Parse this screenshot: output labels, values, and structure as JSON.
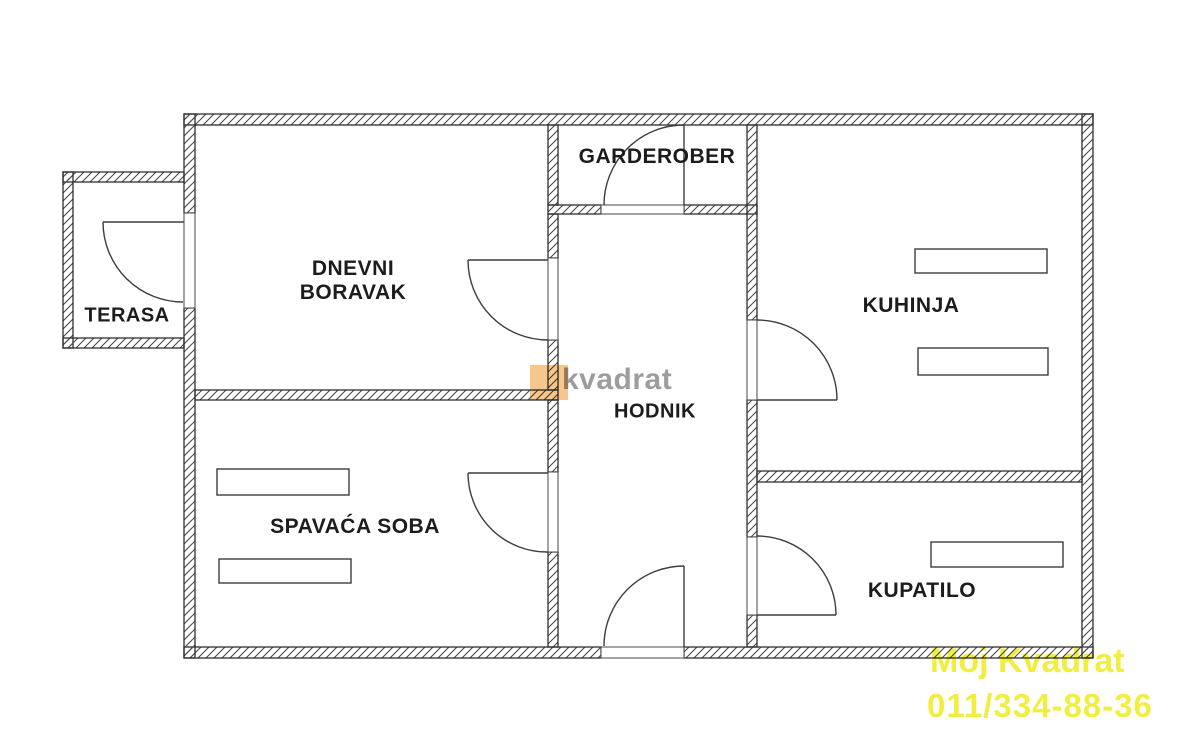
{
  "plan": {
    "rooms": {
      "terrace": {
        "label": "TERASA"
      },
      "living_room": {
        "label_line1": "DNEVNI",
        "label_line2": "BORAVAK"
      },
      "wardrobe": {
        "label": "GARDEROBER"
      },
      "kitchen": {
        "label": "KUHINJA"
      },
      "hallway": {
        "label": "HODNIK"
      },
      "bedroom": {
        "label": "SPAVAĆA SOBA"
      },
      "bathroom": {
        "label": "KUPATILO"
      }
    }
  },
  "watermarks": {
    "logo": {
      "text": "kvadrat",
      "square_color": "#f5c78c",
      "text_color": "#9d9d9d"
    },
    "agency": {
      "line1": "Moj Kvadrat",
      "line2": "011/334-88-36",
      "color": "#f2ee3f"
    }
  },
  "colors": {
    "background": "#ffffff",
    "wall_line": "#2e2e2e",
    "hatch": "#4a4a4a",
    "label_text": "#1c1c1c"
  }
}
